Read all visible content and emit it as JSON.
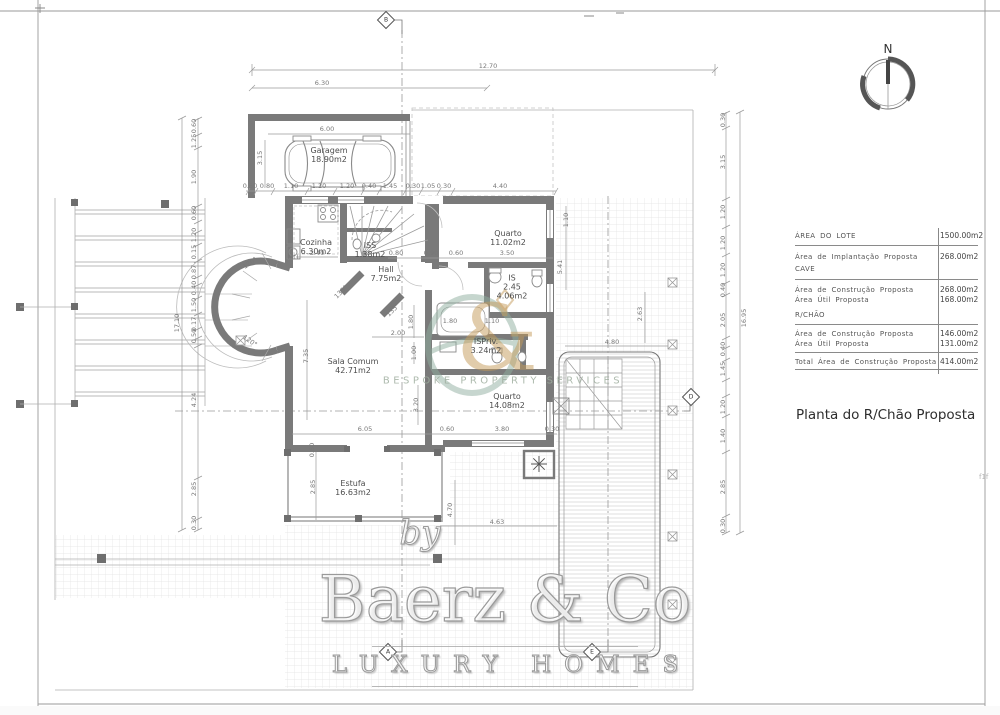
{
  "title": "Planta do R/Chão Proposta",
  "compass": {
    "label": "N"
  },
  "edge_tag": "f1f",
  "colors": {
    "wall": "#7a7a7a",
    "logo_teal": "#8fae9f",
    "logo_gold": "#c49a5a"
  },
  "info_table": {
    "r1_label": "ÁREA DO LOTE",
    "r1_value": "1500.00m2",
    "r2_label": "Área de Implantação Proposta",
    "r2_value": "268.00m2",
    "sub1": "CAVE",
    "r3a_label": "Área de Construção Proposta",
    "r3a_value": "268.00m2",
    "r3b_label": "Área Útil Proposta",
    "r3b_value": "168.00m2",
    "sub2": "R/CHÃO",
    "r4a_label": "Área de Construção Proposta",
    "r4a_value": "146.00m2",
    "r4b_label": "Área Útil Proposta",
    "r4b_value": "131.00m2",
    "r5_label": "Total Área de Construção Proposta",
    "r5_value": "414.00m2"
  },
  "watermark": {
    "by": "by",
    "brand": "Baerz & Co",
    "tagline": "LUXURY HOMES",
    "center_text": "BESPOKE PROPERTY SERVICES",
    "amp": "&"
  },
  "plan": {
    "rooms": [
      {
        "n": "Garagem",
        "a": "18.90m2",
        "x": 329,
        "y": 155
      },
      {
        "n": "Cozinha",
        "a": "6.30m2",
        "x": 316,
        "y": 247
      },
      {
        "n": "ISS",
        "a": "1.38m2",
        "x": 370,
        "y": 250
      },
      {
        "n": "Hall",
        "a": "7.75m2",
        "x": 386,
        "y": 274
      },
      {
        "n": "Quarto",
        "a": "11.02m2",
        "x": 508,
        "y": 238
      },
      {
        "n": "IS",
        "m": "2.45",
        "a": "4.06m2",
        "x": 512,
        "y": 287
      },
      {
        "n": "ISPriv.",
        "a": "3.24m2",
        "x": 486,
        "y": 346
      },
      {
        "n": "Sala Comum",
        "a": "42.71m2",
        "x": 353,
        "y": 366
      },
      {
        "n": "Quarto",
        "a": "14.08m2",
        "x": 507,
        "y": 401
      },
      {
        "n": "Estufa",
        "a": "16.63m2",
        "x": 353,
        "y": 488
      }
    ],
    "markers": [
      {
        "l": "B",
        "x": 386,
        "y": 20
      },
      {
        "l": "A",
        "x": 388,
        "y": 652
      },
      {
        "l": "E",
        "x": 592,
        "y": 652
      },
      {
        "l": "D",
        "x": 691,
        "y": 397
      }
    ],
    "dims": [
      {
        "t": "12.70",
        "x": 488,
        "y": 66
      },
      {
        "t": "6.30",
        "x": 322,
        "y": 83
      },
      {
        "t": "6.00",
        "x": 327,
        "y": 129
      },
      {
        "t": "3.15",
        "x": 260,
        "y": 158,
        "r": -90
      },
      {
        "t": "0.50",
        "x": 250,
        "y": 186
      },
      {
        "t": "0.80",
        "x": 267,
        "y": 186
      },
      {
        "t": "1.10",
        "x": 291,
        "y": 186
      },
      {
        "t": "1.20",
        "x": 319,
        "y": 186
      },
      {
        "t": "1.20",
        "x": 347,
        "y": 186
      },
      {
        "t": "0.40",
        "x": 369,
        "y": 186
      },
      {
        "t": "1.45",
        "x": 390,
        "y": 186
      },
      {
        "t": "0.30",
        "x": 413,
        "y": 186
      },
      {
        "t": "1.05",
        "x": 428,
        "y": 186
      },
      {
        "t": "0.30",
        "x": 444,
        "y": 186
      },
      {
        "t": "4.40",
        "x": 500,
        "y": 186
      },
      {
        "t": "0.60",
        "x": 194,
        "y": 126,
        "r": -90
      },
      {
        "t": "1.25",
        "x": 194,
        "y": 141,
        "r": -90
      },
      {
        "t": "1.90",
        "x": 194,
        "y": 177,
        "r": -90
      },
      {
        "t": "0.60",
        "x": 194,
        "y": 213,
        "r": -90
      },
      {
        "t": "1.20",
        "x": 194,
        "y": 235,
        "r": -90
      },
      {
        "t": "0.15",
        "x": 194,
        "y": 252,
        "r": -90
      },
      {
        "t": "0.87",
        "x": 194,
        "y": 272,
        "r": -90
      },
      {
        "t": "0.40",
        "x": 194,
        "y": 288,
        "r": -90
      },
      {
        "t": "1.50",
        "x": 194,
        "y": 305,
        "r": -90
      },
      {
        "t": "0.17",
        "x": 194,
        "y": 324,
        "r": -90
      },
      {
        "t": "0.50",
        "x": 194,
        "y": 336,
        "r": -90
      },
      {
        "t": "4.24",
        "x": 194,
        "y": 400,
        "r": -90
      },
      {
        "t": "2.85",
        "x": 194,
        "y": 489,
        "r": -90
      },
      {
        "t": "0.30",
        "x": 194,
        "y": 523,
        "r": -90
      },
      {
        "t": "17.10",
        "x": 177,
        "y": 323,
        "r": -90
      },
      {
        "t": "0.30",
        "x": 723,
        "y": 120,
        "r": -90
      },
      {
        "t": "3.15",
        "x": 723,
        "y": 162,
        "r": -90
      },
      {
        "t": "1.20",
        "x": 723,
        "y": 212,
        "r": -90
      },
      {
        "t": "1.20",
        "x": 723,
        "y": 243,
        "r": -90
      },
      {
        "t": "1.20",
        "x": 723,
        "y": 270,
        "r": -90
      },
      {
        "t": "0.40",
        "x": 723,
        "y": 290,
        "r": -90
      },
      {
        "t": "2.05",
        "x": 723,
        "y": 320,
        "r": -90
      },
      {
        "t": "0.40",
        "x": 723,
        "y": 349,
        "r": -90
      },
      {
        "t": "1.45",
        "x": 723,
        "y": 369,
        "r": -90
      },
      {
        "t": "1.20",
        "x": 723,
        "y": 407,
        "r": -90
      },
      {
        "t": "1.40",
        "x": 723,
        "y": 436,
        "r": -90
      },
      {
        "t": "2.85",
        "x": 723,
        "y": 487,
        "r": -90
      },
      {
        "t": "0.30",
        "x": 723,
        "y": 526,
        "r": -90
      },
      {
        "t": "16.95",
        "x": 744,
        "y": 318,
        "r": -90
      },
      {
        "t": "2.40",
        "x": 317,
        "y": 253
      },
      {
        "t": "0.80",
        "x": 396,
        "y": 253
      },
      {
        "t": "0.90",
        "x": 431,
        "y": 253
      },
      {
        "t": "0.60",
        "x": 456,
        "y": 253
      },
      {
        "t": "3.50",
        "x": 507,
        "y": 253
      },
      {
        "t": "1.10",
        "x": 566,
        "y": 220,
        "r": -90
      },
      {
        "t": "5.41",
        "x": 560,
        "y": 267,
        "r": -90
      },
      {
        "t": "1.80",
        "x": 411,
        "y": 322,
        "r": -90
      },
      {
        "t": "2.00",
        "x": 398,
        "y": 333
      },
      {
        "t": "1.00",
        "x": 414,
        "y": 353,
        "r": -90
      },
      {
        "t": "3.20",
        "x": 416,
        "y": 405,
        "r": -90
      },
      {
        "t": "7.35",
        "x": 306,
        "y": 356,
        "r": -90
      },
      {
        "t": "1.80",
        "x": 450,
        "y": 321
      },
      {
        "t": "1.10",
        "x": 492,
        "y": 321
      },
      {
        "t": "6.05",
        "x": 365,
        "y": 429
      },
      {
        "t": "0.60",
        "x": 447,
        "y": 429
      },
      {
        "t": "3.80",
        "x": 502,
        "y": 429
      },
      {
        "t": "0.30",
        "x": 552,
        "y": 429
      },
      {
        "t": "0.50",
        "x": 312,
        "y": 450,
        "r": -90
      },
      {
        "t": "2.85",
        "x": 313,
        "y": 487,
        "r": -90
      },
      {
        "t": "4.70",
        "x": 450,
        "y": 510,
        "r": -90
      },
      {
        "t": "4.63",
        "x": 497,
        "y": 522
      },
      {
        "t": "4.80",
        "x": 612,
        "y": 342
      },
      {
        "t": "2.63",
        "x": 640,
        "y": 314,
        "r": -90
      },
      {
        "t": "120°",
        "x": 250,
        "y": 263,
        "r": -35
      },
      {
        "t": "120°",
        "x": 250,
        "y": 341,
        "r": 35
      },
      {
        "t": "135°",
        "x": 341,
        "y": 292,
        "r": -45
      },
      {
        "t": "135°",
        "x": 393,
        "y": 310,
        "r": -45
      },
      {
        "t": "MLL",
        "x": 294,
        "y": 257
      }
    ]
  }
}
